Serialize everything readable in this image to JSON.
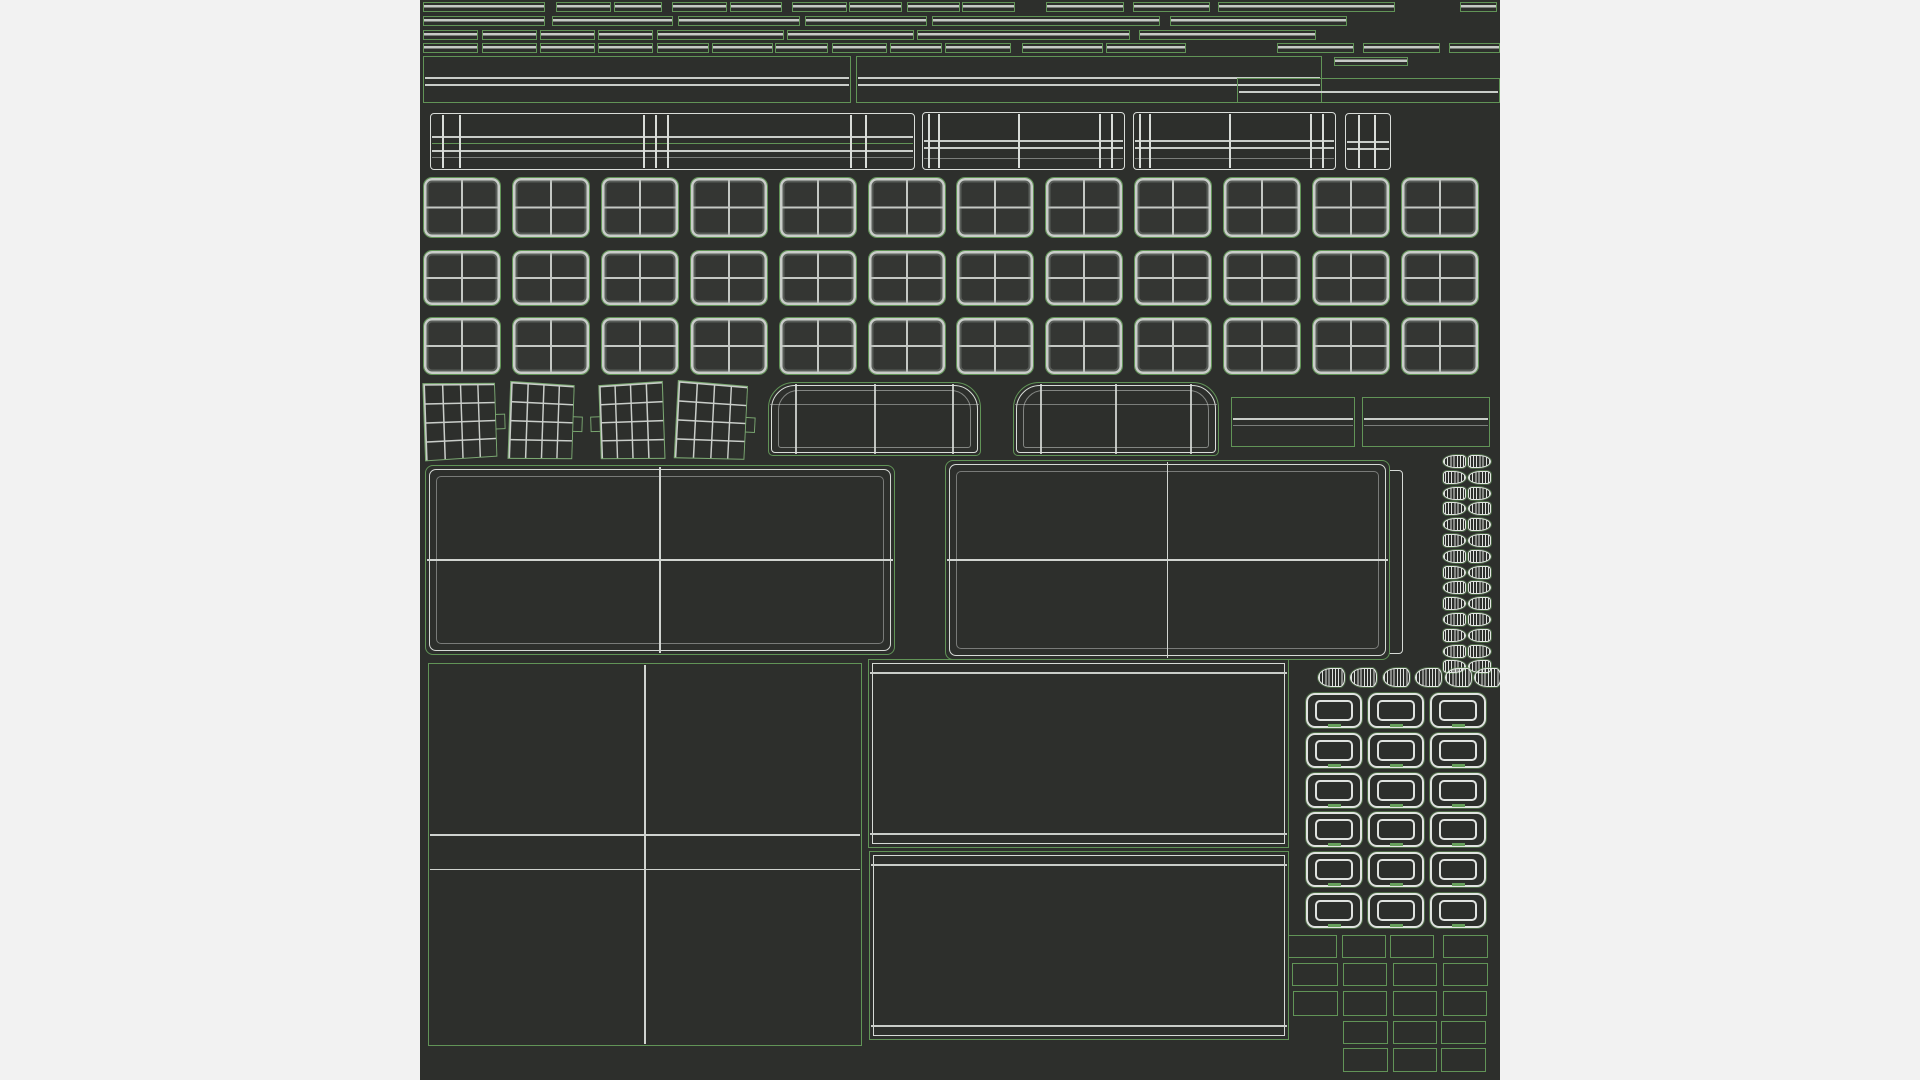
{
  "colors": {
    "background": "#f2f2f2",
    "canvas": "#2d2f2c",
    "island_outline_green": "#619457",
    "wire_gray": "#c9cdc9",
    "wire_bright": "#d9ddd9",
    "wire_white": "#e3e6e3"
  },
  "canvas": {
    "x": 420,
    "y": 0,
    "width": 1080,
    "height": 1080
  },
  "islands": {
    "strips": [
      {
        "y": 2,
        "h": 10,
        "xs": [
          [
            423,
            122
          ],
          [
            556,
            55
          ],
          [
            614,
            48
          ],
          [
            672,
            55
          ],
          [
            730,
            52
          ],
          [
            792,
            55
          ],
          [
            849,
            53
          ],
          [
            907,
            53
          ],
          [
            962,
            53
          ],
          [
            1046,
            78
          ],
          [
            1133,
            77
          ],
          [
            1218,
            177
          ],
          [
            1460,
            37
          ]
        ]
      },
      {
        "y": 16,
        "h": 10,
        "xs": [
          [
            423,
            122
          ],
          [
            552,
            121
          ],
          [
            678,
            122
          ],
          [
            805,
            122
          ],
          [
            932,
            228
          ],
          [
            1170,
            177
          ]
        ]
      },
      {
        "y": 30,
        "h": 10,
        "xs": [
          [
            423,
            55
          ],
          [
            482,
            55
          ],
          [
            540,
            55
          ],
          [
            598,
            55
          ],
          [
            657,
            127
          ],
          [
            787,
            127
          ],
          [
            917,
            213
          ],
          [
            1139,
            177
          ]
        ]
      },
      {
        "y": 43,
        "h": 10,
        "xs": [
          [
            423,
            55
          ],
          [
            482,
            55
          ],
          [
            540,
            55
          ],
          [
            598,
            55
          ],
          [
            657,
            52
          ],
          [
            712,
            61
          ],
          [
            775,
            53
          ],
          [
            832,
            55
          ],
          [
            890,
            52
          ],
          [
            945,
            66
          ],
          [
            1022,
            81
          ],
          [
            1106,
            80
          ],
          [
            1277,
            77
          ],
          [
            1363,
            77
          ],
          [
            1449,
            51
          ]
        ]
      },
      {
        "y": 57,
        "h": 9,
        "xs": [
          [
            1334,
            74
          ]
        ]
      }
    ],
    "panels": [
      {
        "x": 423,
        "y": 56,
        "w": 428,
        "h": 47,
        "hl": [
          [
            0.46,
            ""
          ],
          [
            0.63,
            ""
          ]
        ]
      },
      {
        "x": 856,
        "y": 56,
        "w": 466,
        "h": 47,
        "hl": [
          [
            0.46,
            ""
          ],
          [
            0.63,
            ""
          ]
        ]
      },
      {
        "x": 1237,
        "y": 78,
        "w": 263,
        "h": 25,
        "hl": [
          [
            0.55,
            ""
          ]
        ]
      }
    ],
    "beams": [
      {
        "x": 430,
        "y": 113,
        "w": 485,
        "h": 57,
        "vl": [
          0.025,
          0.06,
          0.44,
          0.465,
          0.49,
          0.87,
          0.9
        ],
        "hl": [
          [
            0.42,
            ""
          ],
          [
            0.55,
            "g"
          ],
          [
            0.68,
            ""
          ],
          [
            0.8,
            "f"
          ]
        ]
      },
      {
        "x": 922,
        "y": 112,
        "w": 203,
        "h": 58,
        "vl": [
          0.03,
          0.08,
          0.48,
          0.88,
          0.94
        ],
        "hl": [
          [
            0.5,
            ""
          ],
          [
            0.63,
            ""
          ],
          [
            0.82,
            "f"
          ]
        ]
      },
      {
        "x": 1133,
        "y": 112,
        "w": 203,
        "h": 58,
        "vl": [
          0.03,
          0.08,
          0.48,
          0.88,
          0.94
        ],
        "hl": [
          [
            0.5,
            ""
          ],
          [
            0.63,
            ""
          ],
          [
            0.82,
            "f"
          ]
        ]
      },
      {
        "x": 1345,
        "y": 113,
        "w": 46,
        "h": 57,
        "vl": [
          0.3,
          0.65
        ],
        "hl": [
          [
            0.5,
            ""
          ],
          [
            0.63,
            ""
          ]
        ]
      }
    ],
    "keycaps": {
      "x0": 423,
      "pitch": 88.9,
      "cols": 12,
      "w": 78,
      "rows": [
        {
          "y": 177,
          "h": 61
        },
        {
          "y": 250,
          "h": 56
        },
        {
          "y": 317,
          "h": 58
        }
      ]
    },
    "fans": {
      "y": 383,
      "h": 76,
      "items": [
        {
          "x": 424,
          "w": 74,
          "ry": 12,
          "rz": -2,
          "tab": "right"
        },
        {
          "x": 509,
          "w": 66,
          "ry": 12,
          "rz": 2,
          "tab": "right"
        },
        {
          "x": 598,
          "w": 66,
          "ry": -12,
          "rz": -2,
          "tab": "left"
        },
        {
          "x": 676,
          "w": 72,
          "ry": 12,
          "rz": 3,
          "tab": "right"
        }
      ]
    },
    "arches": {
      "y": 382,
      "h": 74,
      "items": [
        {
          "x": 768,
          "w": 213
        },
        {
          "x": 1013,
          "w": 206
        }
      ]
    },
    "flat_rects": {
      "y": 397,
      "h": 50,
      "items": [
        {
          "x": 1231,
          "w": 124
        },
        {
          "x": 1362,
          "w": 128
        }
      ]
    },
    "ghost": {
      "x": 958,
      "y": 470,
      "w": 445,
      "h": 184
    },
    "big_panels": [
      {
        "x": 425,
        "y": 465,
        "w": 470,
        "h": 190
      },
      {
        "x": 945,
        "y": 460,
        "w": 445,
        "h": 200
      }
    ],
    "teeth": {
      "cols": [
        1443,
        1468
      ],
      "y0": 455,
      "pitch": 15.8,
      "count": 14,
      "w": 23,
      "h": 13
    },
    "cones": {
      "y": 668,
      "h": 19,
      "w": 27,
      "xs": [
        1318,
        1350,
        1383,
        1415,
        1445,
        1474
      ]
    },
    "square_panel": {
      "x": 428,
      "y": 663,
      "w": 434,
      "h": 383
    },
    "stacks": [
      {
        "x": 868,
        "y": 659,
        "w": 421,
        "h": 189
      },
      {
        "x": 869,
        "y": 851,
        "w": 420,
        "h": 189
      }
    ],
    "frames": {
      "cols": [
        1306,
        1368,
        1430
      ],
      "w": 56,
      "rows": [
        693,
        733,
        773,
        812,
        852,
        893
      ],
      "h": 35
    },
    "small_rects": [
      {
        "y": 935,
        "h": 23,
        "xs": [
          [
            1288,
            49
          ],
          [
            1342,
            44
          ],
          [
            1390,
            44
          ],
          [
            1443,
            45
          ]
        ]
      },
      {
        "y": 963,
        "h": 23,
        "xs": [
          [
            1292,
            46
          ],
          [
            1343,
            44
          ],
          [
            1393,
            44
          ],
          [
            1443,
            45
          ]
        ]
      },
      {
        "y": 991,
        "h": 25,
        "xs": [
          [
            1293,
            45
          ],
          [
            1343,
            44
          ],
          [
            1393,
            44
          ],
          [
            1443,
            44
          ]
        ]
      },
      {
        "y": 1021,
        "h": 23,
        "xs": [
          [
            1343,
            45
          ],
          [
            1393,
            44
          ],
          [
            1441,
            45
          ]
        ]
      },
      {
        "y": 1048,
        "h": 24,
        "xs": [
          [
            1343,
            45
          ],
          [
            1393,
            44
          ],
          [
            1441,
            45
          ]
        ]
      }
    ]
  }
}
